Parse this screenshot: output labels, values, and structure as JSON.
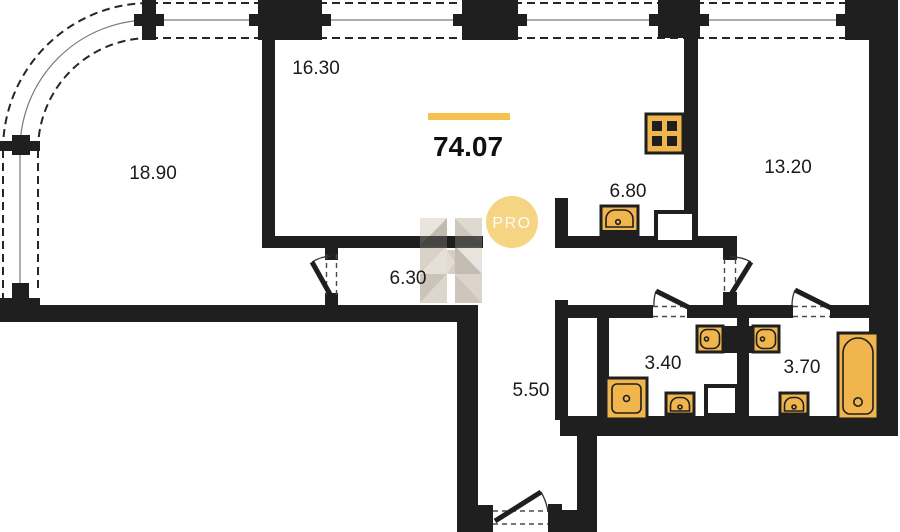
{
  "plan": {
    "total_area": "74.07",
    "watermark": {
      "badge": "PRO"
    },
    "rooms": [
      {
        "name": "living-room",
        "area": "18.90"
      },
      {
        "name": "room",
        "area": "16.30"
      },
      {
        "name": "bedroom",
        "area": "13.20"
      },
      {
        "name": "kitchen",
        "area": "6.80"
      },
      {
        "name": "corridor",
        "area": "6.30"
      },
      {
        "name": "hall",
        "area": "5.50"
      },
      {
        "name": "bathroom-1",
        "area": "3.40"
      },
      {
        "name": "bathroom-2",
        "area": "3.70"
      }
    ],
    "colors": {
      "wall": "#1f1f1f",
      "fixture": "#f0b54d",
      "accent": "#f6c14f",
      "watermark_circle": "#f5d584",
      "background": "#ffffff"
    }
  }
}
